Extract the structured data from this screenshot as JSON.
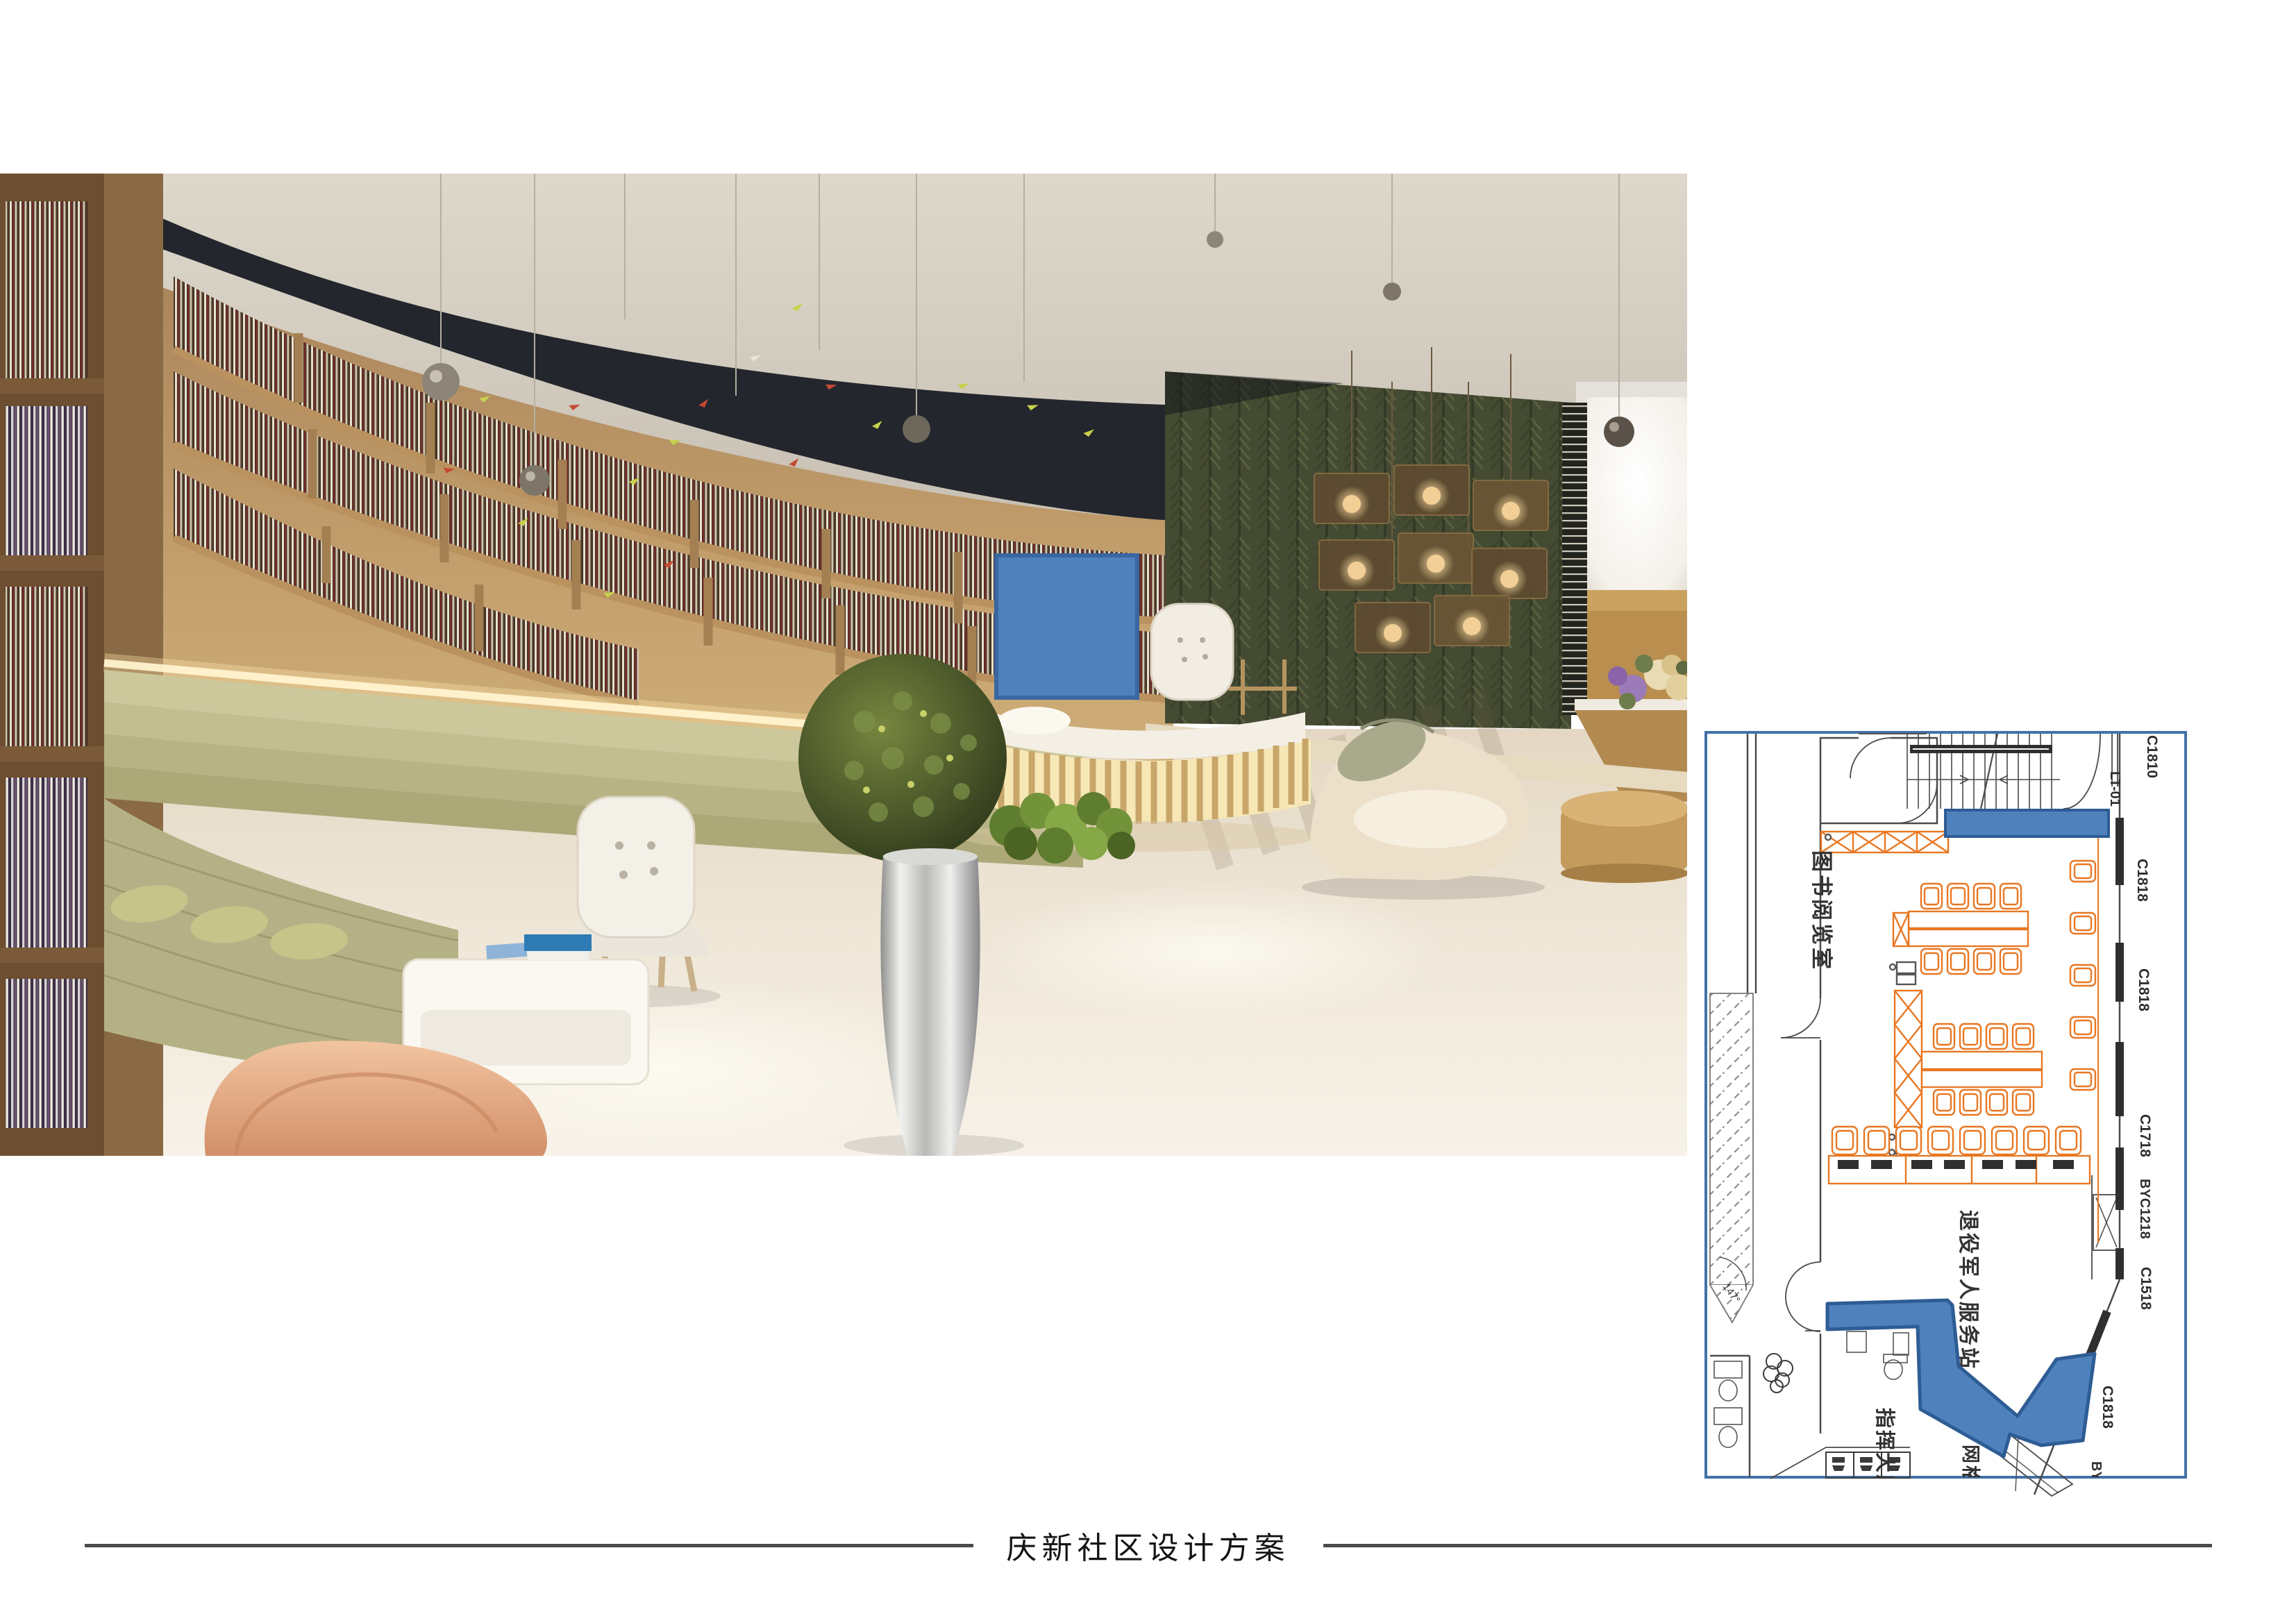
{
  "document": {
    "footer_title": "庆新社区设计方案"
  },
  "colors": {
    "highlight_blue": "#4f81bd",
    "highlight_blue_border": "#365f91",
    "plan_furniture_orange": "#e87722",
    "plan_frame_blue": "#4472a8"
  },
  "floor_plan": {
    "labels": {
      "c1810": "C1810",
      "lt01": "LT-01",
      "c1818_top": "C1818",
      "c1818_mid": "C1818",
      "c1718": "C1718",
      "byc1218": "BYC1218",
      "c1518": "C1518",
      "c1818_diag": "C1818",
      "by_partial": "BY",
      "reading_room": "图书阅览室",
      "veterans_station": "退役军人服务站",
      "command_hall": "指挥大厅",
      "grid_room": "网格",
      "angle": "147°"
    }
  }
}
